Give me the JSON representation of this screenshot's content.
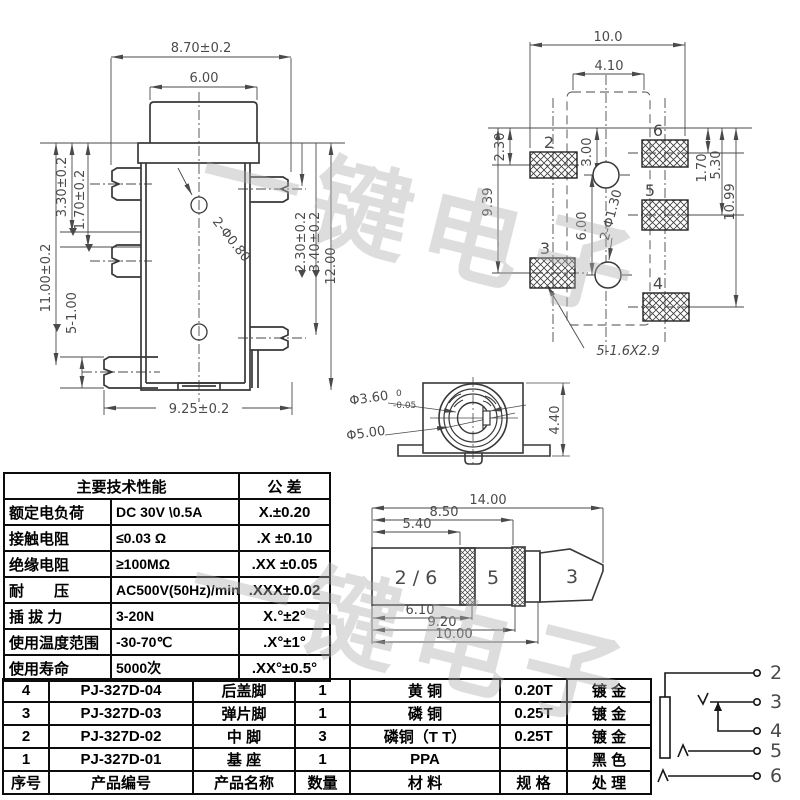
{
  "watermark": {
    "text": "一键电子"
  },
  "side_view": {
    "dims": {
      "w_top": "8.70±0.2",
      "w_hat": "6.00",
      "h_330": "3.30±0.2",
      "h_170": "1.70±0.2",
      "h_1100": "11.00±0.2",
      "pins": "5-1.00",
      "holes": "2-Φ0.80",
      "h_230": "2.30±0.2",
      "h_340": "3.40±0.2",
      "h_1200": "12.00",
      "w_bottom": "9.25±0.2"
    }
  },
  "pcb_view": {
    "dims": {
      "w_total": "10.0",
      "w_inner": "4.10",
      "d_230": "2.30",
      "d_939": "9.39",
      "d_300": "3.00",
      "d_600": "6.00",
      "holes": "2-Φ1.30",
      "d_170": "1.70",
      "d_530": "5.30",
      "d_1099": "10.99",
      "pad_note": "5-1.6X2.9"
    },
    "pads": {
      "p2": "2",
      "p6": "6",
      "p5": "5",
      "p3": "3",
      "p4": "4"
    }
  },
  "front_view": {
    "dia_inner": "Φ3.60",
    "tol_upper": "0",
    "tol_lower": "-0.05",
    "dia_outer": "Φ5.00",
    "height": "4.40"
  },
  "plug_view": {
    "dims": {
      "d_1400": "14.00",
      "d_850": "8.50",
      "d_540": "5.40",
      "d_610": "6.10",
      "d_920": "9.20",
      "d_1000": "10.00"
    },
    "segments": {
      "s26": "2 / 6",
      "s5": "5",
      "s3": "3"
    }
  },
  "schematic": {
    "terminals": [
      "2",
      "3",
      "4",
      "5",
      "6"
    ]
  },
  "spec_table": {
    "header_main": "主要技术性能",
    "header_tol": "公 差",
    "rows": [
      {
        "name": "额定电负荷",
        "value": "DC 30V \\0.5A",
        "tol": "X.±0.20"
      },
      {
        "name": "接触电阻",
        "value": "≤0.03 Ω",
        "tol": ".X ±0.10"
      },
      {
        "name": "绝缘电阻",
        "value": "≥100MΩ",
        "tol": ".XX ±0.05"
      },
      {
        "name": "耐　　压",
        "value": "AC500V(50Hz)/min",
        "tol": ".XXX±0.02"
      },
      {
        "name": "插 拔 力",
        "value": "3-20N",
        "tol": "X.°±2°"
      },
      {
        "name": "使用温度范围",
        "value": "-30-70℃",
        "tol": ".X°±1°"
      },
      {
        "name": "使用寿命",
        "value": "5000次",
        "tol": ".XX°±0.5°"
      }
    ]
  },
  "parts_table": {
    "rows": [
      {
        "no": "4",
        "part_no": "PJ-327D-04",
        "name": "后盖脚",
        "qty": "1",
        "material": "黄 铜",
        "spec": "0.20T",
        "finish": "镀 金"
      },
      {
        "no": "3",
        "part_no": "PJ-327D-03",
        "name": "弹片脚",
        "qty": "1",
        "material": "磷 铜",
        "spec": "0.25T",
        "finish": "镀 金"
      },
      {
        "no": "2",
        "part_no": "PJ-327D-02",
        "name": "中 脚",
        "qty": "3",
        "material": "磷铜（T T）",
        "spec": "0.25T",
        "finish": "镀 金"
      },
      {
        "no": "1",
        "part_no": "PJ-327D-01",
        "name": "基 座",
        "qty": "1",
        "material": "PPA",
        "spec": "",
        "finish": "黑 色"
      }
    ],
    "footer": {
      "no": "序号",
      "part_no": "产品编号",
      "name": "产品名称",
      "qty": "数量",
      "material": "材 料",
      "spec": "规 格",
      "finish": "处 理"
    }
  }
}
